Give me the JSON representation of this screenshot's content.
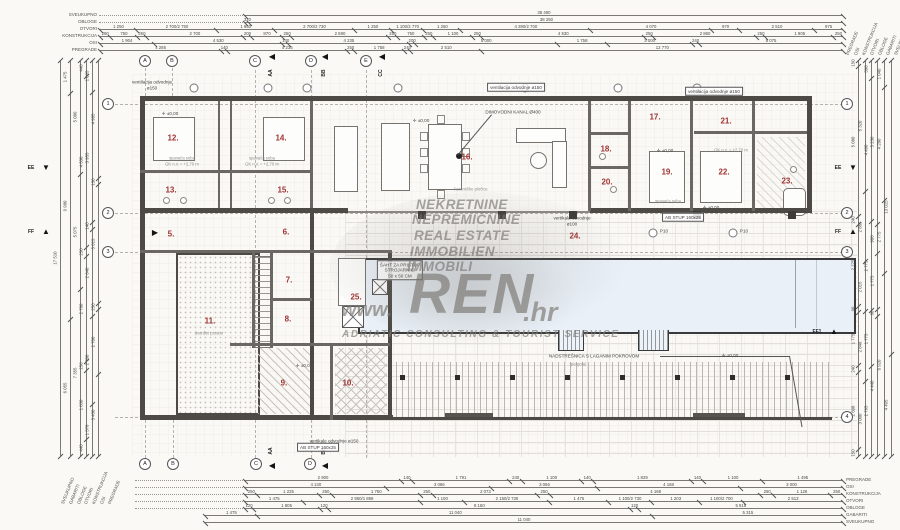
{
  "colors": {
    "room_number": "#a03432",
    "pool_fill": "#e9f0f7",
    "wall": "#4d4a46",
    "watermark_gray": "#8f8d89",
    "paper": "#faf9f6"
  },
  "watermark": {
    "lines": [
      "NEKRETNINE",
      "NEPREMIČNINE",
      "REAL ESTATE",
      "IMMOBILIEN",
      "IMMOBILI"
    ],
    "brand_prefix": "www.",
    "brand": "REN",
    "brand_suffix": ".hr",
    "tagline": "ADRIATIC CONSULTING & TOURIST SERVICE"
  },
  "plan": {
    "rooms": [
      {
        "num": "5.",
        "x": 171,
        "y": 234
      },
      {
        "num": "6.",
        "x": 286,
        "y": 232
      },
      {
        "num": "7.",
        "x": 289,
        "y": 280
      },
      {
        "num": "8.",
        "x": 288,
        "y": 319
      },
      {
        "num": "9.",
        "x": 284,
        "y": 383
      },
      {
        "num": "10.",
        "x": 348,
        "y": 383
      },
      {
        "num": "11.",
        "x": 210,
        "y": 321
      },
      {
        "num": "12.",
        "x": 173,
        "y": 138
      },
      {
        "num": "13.",
        "x": 171,
        "y": 190
      },
      {
        "num": "14.",
        "x": 281,
        "y": 138
      },
      {
        "num": "15.",
        "x": 283,
        "y": 190
      },
      {
        "num": "16.",
        "x": 467,
        "y": 157
      },
      {
        "num": "17.",
        "x": 655,
        "y": 117
      },
      {
        "num": "18.",
        "x": 606,
        "y": 149
      },
      {
        "num": "19.",
        "x": 667,
        "y": 172
      },
      {
        "num": "20.",
        "x": 607,
        "y": 182
      },
      {
        "num": "21.",
        "x": 726,
        "y": 121
      },
      {
        "num": "22.",
        "x": 724,
        "y": 172
      },
      {
        "num": "23.",
        "x": 787,
        "y": 181
      },
      {
        "num": "24.",
        "x": 575,
        "y": 236
      },
      {
        "num": "25.",
        "x": 356,
        "y": 297
      }
    ],
    "captions": [
      {
        "t": "spavaća soba",
        "x": 182,
        "y": 158
      },
      {
        "t": "GK n.v. = +2,70 m",
        "x": 182,
        "y": 164
      },
      {
        "t": "spavaća soba",
        "x": 262,
        "y": 158
      },
      {
        "t": "GK n.v. = +2,70 m",
        "x": 262,
        "y": 164
      },
      {
        "t": "keramičke pločice",
        "x": 471,
        "y": 189
      },
      {
        "t": "GK n.v. = +2,70 m",
        "x": 731,
        "y": 150
      },
      {
        "t": "spavaća soba",
        "x": 668,
        "y": 201
      },
      {
        "t": "dvorišni prostor",
        "x": 209,
        "y": 333
      },
      {
        "t": "(pergola)",
        "x": 578,
        "y": 364
      }
    ],
    "elevations": [
      {
        "t": "±0,00",
        "x": 170,
        "y": 114
      },
      {
        "t": "±0,00",
        "x": 421,
        "y": 121
      },
      {
        "t": "±0,00",
        "x": 665,
        "y": 151
      },
      {
        "t": "±0,00",
        "x": 730,
        "y": 356
      },
      {
        "t": "±0,00",
        "x": 304,
        "y": 366
      },
      {
        "t": "±0,00",
        "x": 711,
        "y": 208
      }
    ],
    "annotations": [
      {
        "lines": [
          "ventilacija odvodnje",
          "ø150"
        ],
        "x": 152,
        "y": 85
      },
      {
        "text": "ventilacija odvodnje ø150",
        "x": 516,
        "y": 87,
        "boxed": true
      },
      {
        "text": "ventilacija odvodnje ø150",
        "x": 714,
        "y": 91,
        "boxed": true
      },
      {
        "text": "DIMOVODNI KANAL Ø400",
        "x": 513,
        "y": 112
      },
      {
        "lines": [
          "ŠAHT ZA PRISTUP",
          "STROJARNICI",
          "50 x 50 CM"
        ],
        "x": 400,
        "y": 270,
        "boxed": true
      },
      {
        "text": "AB STUP 160x25",
        "x": 683,
        "y": 217,
        "boxed": true
      },
      {
        "text": "AB STUP 160x25",
        "x": 318,
        "y": 447,
        "boxed": true
      },
      {
        "lines": [
          "vertikala odvodnje",
          "ø100"
        ],
        "x": 572,
        "y": 221
      },
      {
        "text": "vertikale odvodnje ø150",
        "x": 334,
        "y": 441
      },
      {
        "text": "NADSTREŠNICA S LAGANIM POKROVOM",
        "x": 594,
        "y": 356
      },
      {
        "text": "P10",
        "x": 664,
        "y": 231
      },
      {
        "text": "P10",
        "x": 744,
        "y": 231
      }
    ]
  },
  "axes": [
    {
      "label": "A",
      "x": 145,
      "y": 61
    },
    {
      "label": "B",
      "x": 172,
      "y": 61
    },
    {
      "label": "C",
      "x": 255,
      "y": 61
    },
    {
      "label": "D",
      "x": 311,
      "y": 61
    },
    {
      "label": "E",
      "x": 366,
      "y": 61
    },
    {
      "label": "A",
      "x": 145,
      "y": 464
    },
    {
      "label": "B",
      "x": 173,
      "y": 464
    },
    {
      "label": "C",
      "x": 256,
      "y": 464
    },
    {
      "label": "D",
      "x": 310,
      "y": 464
    },
    {
      "label": "1",
      "x": 108,
      "y": 104
    },
    {
      "label": "2",
      "x": 108,
      "y": 213
    },
    {
      "label": "3",
      "x": 108,
      "y": 252
    },
    {
      "label": "1",
      "x": 847,
      "y": 104
    },
    {
      "label": "2",
      "x": 847,
      "y": 213
    },
    {
      "label": "3",
      "x": 847,
      "y": 252
    },
    {
      "label": "4",
      "x": 847,
      "y": 417
    }
  ],
  "sections": [
    {
      "label": "AA",
      "tri": "◀",
      "tx": 272,
      "ty": 57,
      "lx": 271,
      "ly": 73,
      "rot": 1
    },
    {
      "label": "BB",
      "tri": "◀",
      "tx": 325,
      "ty": 57,
      "lx": 324,
      "ly": 73,
      "rot": 1
    },
    {
      "label": "CC",
      "tri": "◀",
      "tx": 382,
      "ty": 57,
      "lx": 381,
      "ly": 73,
      "rot": 1
    },
    {
      "label": "AA",
      "tri": "◀",
      "tx": 272,
      "ty": 466,
      "lx": 271,
      "ly": 451,
      "rot": 1
    },
    {
      "label": "BB",
      "tri": "◀",
      "tx": 325,
      "ty": 466,
      "lx": 324,
      "ly": 451,
      "rot": 1
    },
    {
      "label": "EE",
      "tri": "▼",
      "tx": 46,
      "ty": 168,
      "lx": 31,
      "ly": 168,
      "rot": 0
    },
    {
      "label": "FF",
      "tri": "▲",
      "tx": 46,
      "ty": 232,
      "lx": 31,
      "ly": 232,
      "rot": 0
    },
    {
      "label": "EE",
      "tri": "▼",
      "tx": 853,
      "ty": 168,
      "lx": 838,
      "ly": 168,
      "rot": 0
    },
    {
      "label": "FF",
      "tri": "▲",
      "tx": 853,
      "ty": 232,
      "lx": 838,
      "ly": 232,
      "rot": 0
    },
    {
      "label": "FF1",
      "tri": "▲",
      "tx": 834,
      "ty": 332,
      "lx": 817,
      "ly": 332,
      "rot": 0
    },
    {
      "label": "",
      "tri": "▶",
      "tx": 155,
      "ty": 233,
      "lx": 155,
      "ly": 233,
      "rot": 0
    }
  ],
  "dims": {
    "top": [
      {
        "label": "SVEUKUPNO",
        "y": 15,
        "x1": 245,
        "x2": 843,
        "segs": [
          "38 490"
        ]
      },
      {
        "label": "OBLOGE",
        "y": 22,
        "x1": 245,
        "x2": 843,
        "segs": [
          "320",
          "38 250"
        ]
      },
      {
        "label": "OTVORI",
        "y": 29,
        "x1": 100,
        "x2": 843,
        "segs": [
          "1 250",
          "2 700/2 750",
          "1 950",
          "2 700/2 730",
          "1 250",
          "1 100/2 770",
          "1 250",
          "4 390/2 700",
          "4 070",
          "970",
          "2 510",
          "975"
        ]
      },
      {
        "label": "KONSTRUKCIJA",
        "y": 36,
        "x1": 100,
        "x2": 843,
        "segs": [
          "290",
          "750",
          "250",
          "2 700",
          "200",
          "870",
          "250",
          "2 690",
          "250",
          "750",
          "250",
          "1 100",
          "250",
          "4 530",
          "250",
          "2 860",
          "250",
          "1 905",
          "250"
        ]
      },
      {
        "label": "OSI",
        "y": 43,
        "x1": 100,
        "x2": 843,
        "segs": [
          "1 904",
          "4 530",
          "140",
          "4 235",
          "200",
          "5 000",
          "1 758",
          "3 000",
          "240",
          "5 075"
        ]
      },
      {
        "label": "PREGRADE",
        "y": 50,
        "x1": 100,
        "x2": 843,
        "segs": [
          "4 285",
          "140",
          "4 235",
          "250",
          "1 758",
          "240",
          "2 510",
          "12 770"
        ]
      }
    ],
    "bottom": [
      {
        "label": "PREGRADE",
        "y": 480,
        "x1": 245,
        "x2": 843,
        "segs": [
          "2 900",
          "140",
          "1 791",
          "240",
          "1 100",
          "140",
          "1 829",
          "140",
          "1 100",
          "1 495"
        ]
      },
      {
        "label": "OSI",
        "y": 487,
        "x1": 245,
        "x2": 843,
        "segs": [
          "4 130",
          "3 066",
          "3 066",
          "4 168",
          "3 000"
        ]
      },
      {
        "label": "KONSTRUKCIJA",
        "y": 494,
        "x1": 245,
        "x2": 843,
        "segs": [
          "250",
          "1 225",
          "250",
          "1 750",
          "250",
          "2 073",
          "250",
          "4 168",
          "250",
          "1 126",
          "250"
        ]
      },
      {
        "label": "OTVORI",
        "y": 501,
        "x1": 245,
        "x2": 843,
        "segs": [
          "1 475",
          "2 950/1 898",
          "1 100",
          "2 150/2 730",
          "1 475",
          "1 100/2 730",
          "1 203",
          "1 100/2 700",
          "2 513"
        ]
      },
      {
        "label": "OBLOGE",
        "y": 508,
        "x1": 245,
        "x2": 843,
        "segs": [
          "120",
          "1 805",
          "120",
          "8 160",
          "120",
          "5 515"
        ]
      },
      {
        "label": "GABARITI",
        "y": 515,
        "x1": 205,
        "x2": 843,
        "segs": [
          "1 475",
          "11 040",
          "5 315"
        ]
      },
      {
        "label": "SVEUKUPNO",
        "y": 522,
        "x1": 205,
        "x2": 843,
        "segs": [
          "11 040"
        ]
      }
    ],
    "left": [
      {
        "x": 60,
        "segs": [
          "17 510"
        ]
      },
      {
        "x": 70,
        "segs": [
          "1 475",
          "9 980",
          "6 055"
        ]
      },
      {
        "x": 80,
        "segs": [
          "5 080",
          "5 075",
          "7 355"
        ]
      },
      {
        "x": 86,
        "segs": [
          "440",
          "4 530",
          "250",
          "2 780",
          "250",
          "1 830",
          "440"
        ]
      },
      {
        "x": 92,
        "segs": [
          "1 005",
          "3 955",
          "140",
          "2 640",
          "2 700",
          "1 570"
        ]
      },
      {
        "x": 98,
        "segs": [
          "4 985",
          "130",
          "5 015",
          "250",
          "2 700",
          "3 430"
        ]
      }
    ],
    "right": [
      {
        "x": 858,
        "segs": [
          "150",
          "5 080",
          "240",
          "2 775",
          "90",
          "1 775",
          "240",
          "2 608",
          "150"
        ]
      },
      {
        "x": 865,
        "segs": [
          "5 320",
          "2 865",
          "2 015",
          "2 848",
          "3 000"
        ]
      },
      {
        "x": 871,
        "segs": [
          "590",
          "4 490",
          "2 775",
          "1 775",
          "2 795"
        ]
      },
      {
        "x": 877,
        "segs": [
          "5 230",
          "908",
          "1 775",
          "60",
          "4 440"
        ]
      },
      {
        "x": 884,
        "segs": [
          "1 040",
          "4 280",
          "2 775",
          "6 920"
        ]
      },
      {
        "x": 891,
        "segs": [
          "13 015",
          "4 495"
        ]
      }
    ],
    "right_labels": [
      "PREGRADE",
      "OSI",
      "KONSTRUKCIJA",
      "OTVORI",
      "OBLOGE",
      "GABARITI",
      "SVEUKUPNO"
    ]
  }
}
